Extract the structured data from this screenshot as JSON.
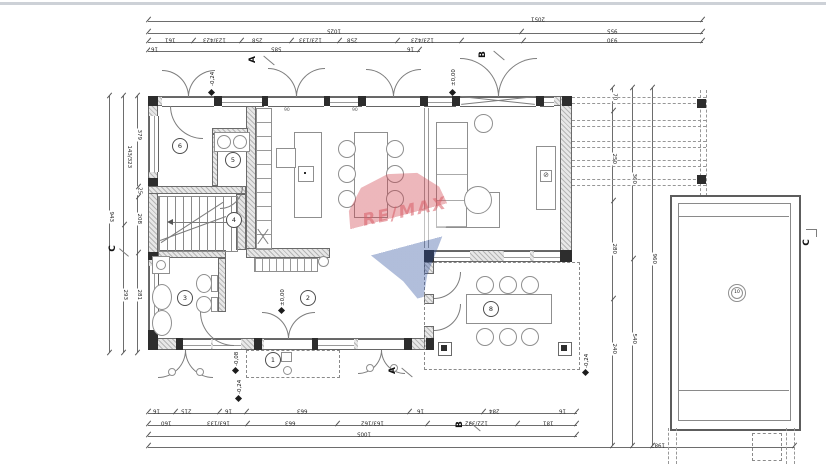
{
  "watermark": {
    "brand": "RE/MAX",
    "red": "#cf3e4a",
    "blue": "#2e509e"
  },
  "rooms": {
    "r1": "1",
    "r2": "2",
    "r3": "3",
    "r4": "4",
    "r5": "5",
    "r6": "6",
    "terrace": "8",
    "pool": "10"
  },
  "sections": {
    "a": "A",
    "b": "B",
    "c": "C"
  },
  "levels": {
    "top_left": "-0,24",
    "top_right": "±0,00",
    "hall": "±0,00",
    "porch_upper": "-0,08",
    "porch_lower": "-0,24",
    "terrace_corner": "-0,24"
  },
  "notes": {
    "sill": "90"
  },
  "dims": {
    "top1": [
      "2051"
    ],
    "top2": [
      "1025",
      "955"
    ],
    "top3": [
      "161",
      "123/423",
      "258",
      "123/133",
      "258",
      "123/423",
      "930"
    ],
    "top4": [
      "16",
      "585",
      "16"
    ],
    "bottom1": [
      "16",
      "215",
      "16",
      "663",
      "16",
      "284",
      "16"
    ],
    "bottom2": [
      "160",
      "163/133",
      "663",
      "163/162",
      "122/332",
      "181"
    ],
    "bottom3": [
      "1005"
    ],
    "bottom4": [
      "1987"
    ],
    "left_inner": [
      "379",
      "25",
      "208",
      "281"
    ],
    "left_mid": [
      "143/323",
      "293"
    ],
    "left_outer": [
      "943"
    ],
    "right1": [
      "70",
      "250",
      "280",
      "240"
    ],
    "right2": [
      "360",
      "540"
    ],
    "right3": [
      "960"
    ]
  }
}
